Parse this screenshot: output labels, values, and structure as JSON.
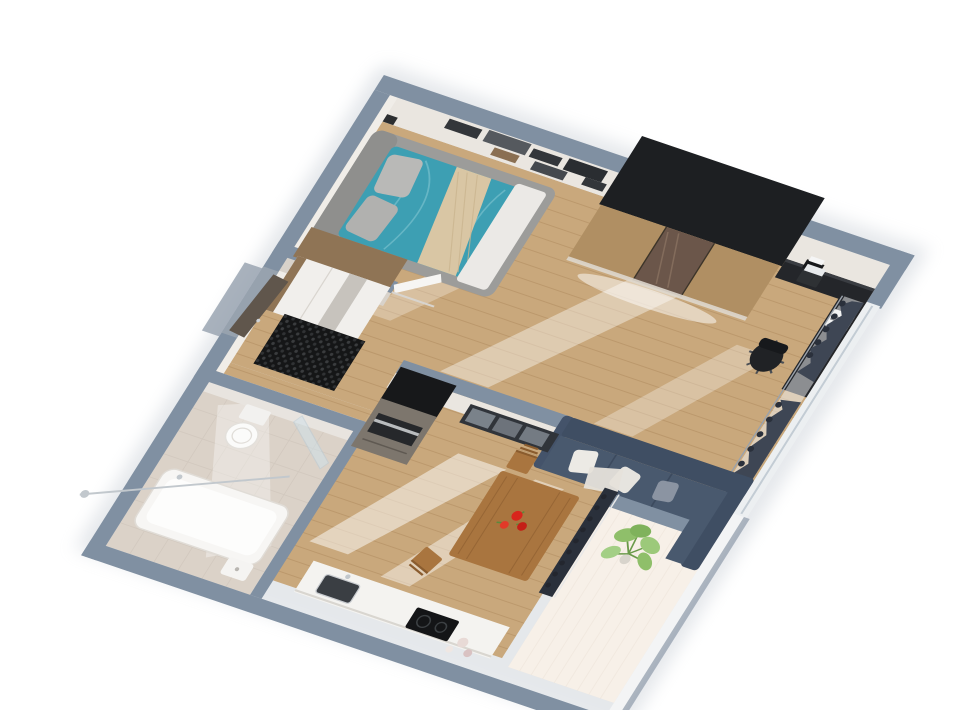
{
  "meta": {
    "kind": "3d-floorplan-render",
    "description": "Isometric top-down 3D render of a one-bedroom apartment on a white background, plan rotated diagonally",
    "background": "#ffffff"
  },
  "scene": {
    "rooms": [
      {
        "name": "bedroom-office",
        "furniture": [
          "double-bed-teal-bedding",
          "wall-shelves",
          "sliding-door-wardrobe",
          "black-desk-with-laptop-and-printer",
          "office-chair",
          "window-with-dark-curtains"
        ]
      },
      {
        "name": "living-area",
        "furniture": [
          "corner-sofa-slate-blue",
          "glass-sideboard"
        ]
      },
      {
        "name": "kitchen-dining",
        "furniture": [
          "dining-table-with-red-flowers",
          "wood-chairs",
          "fridge-oven-column",
          "white-counter-with-sink",
          "black-cooktop",
          "pottery"
        ]
      },
      {
        "name": "hallway",
        "furniture": [
          "entrance-door",
          "black-doormat",
          "mirror-front-wardrobe",
          "white-interior-door"
        ]
      },
      {
        "name": "bathroom",
        "furniture": [
          "bathtub",
          "toilet",
          "shower-glass-panel",
          "chrome-shower-rod",
          "small-sink"
        ]
      },
      {
        "name": "balcony",
        "furniture": [
          "potted-green-plant"
        ]
      }
    ]
  },
  "palette": {
    "background": "#ffffff",
    "shadow": "#b6bec8",
    "wallCap": "#8090a2",
    "wallCapLight": "#98a4b2",
    "wallFace": "#eae6e0",
    "wallFaceShade": "#d8d2ca",
    "woodFloor": "#c9a87c",
    "woodPlank": "#ab8558",
    "sunlight": "#ffffff",
    "balconyFloor": "#eee0d0",
    "balconyPlank": "#ddcbb6",
    "bathFloor": "#dbd2c8",
    "bathTile": "#cfc5ba",
    "bedFrame": "#9c9c9a",
    "bedHead": "#8f8f8d",
    "bedDuvet": "#3d9fb3",
    "bedDuvetFold": "#7cc3cf",
    "bedPillow": "#b9b9b7",
    "bedThrow": "#d9c6a4",
    "bedFootBlanket": "#ebe9e6",
    "shelfDark": "#33363a",
    "shelfMid": "#55595e",
    "shelfWood": "#8a6f52",
    "wardrobeTop": "#1d1f22",
    "wardrobeWood": "#b08f63",
    "wardrobeMirror": "#6b564a",
    "hallWardrobeWood": "#8f7455",
    "hallWardrobeDoor": "#f1efec",
    "hallWardrobeMirror": "#c7c3bd",
    "deskBlack": "#24262a",
    "chairBlack": "#202225",
    "laptopScreen": "#e8eaec",
    "printerWhite": "#f0f0ee",
    "curtain": "#3e4654",
    "curtainDark": "#2a303b",
    "sofa": "#49596e",
    "sofaDark": "#3f4e63",
    "pillowWhite": "#eceae5",
    "pillowGray": "#8b94a2",
    "blanketCream": "#e6e2da",
    "tableWood": "#a9753f",
    "flowerRed": "#d8251c",
    "leafGreen": "#5c8a3c",
    "sideboard": "#30343a",
    "glassPane": "#b8c2cc",
    "applianceTop": "#17181a",
    "applianceBody": "#7d766d",
    "ovenDark": "#26282b",
    "steel": "#b9bcbe",
    "counterWhite": "#f4f3f0",
    "sinkDark": "#3a3e43",
    "cooktop": "#141517",
    "doormat": "#151617",
    "doormatDot": "#3a3c3e",
    "door": "#60564c",
    "doorFrame": "#97a2ae",
    "toiletWhite": "#fbfbfa",
    "tubWhite": "#f7f6f4",
    "showerGlass": "#cfe2ec",
    "chrome": "#c2c8cd",
    "plantGreen": "#8fbf6a",
    "plantStem": "#6a9a4a",
    "windowFrame": "#eceff1",
    "balconyWall": "#f3f4f5"
  }
}
